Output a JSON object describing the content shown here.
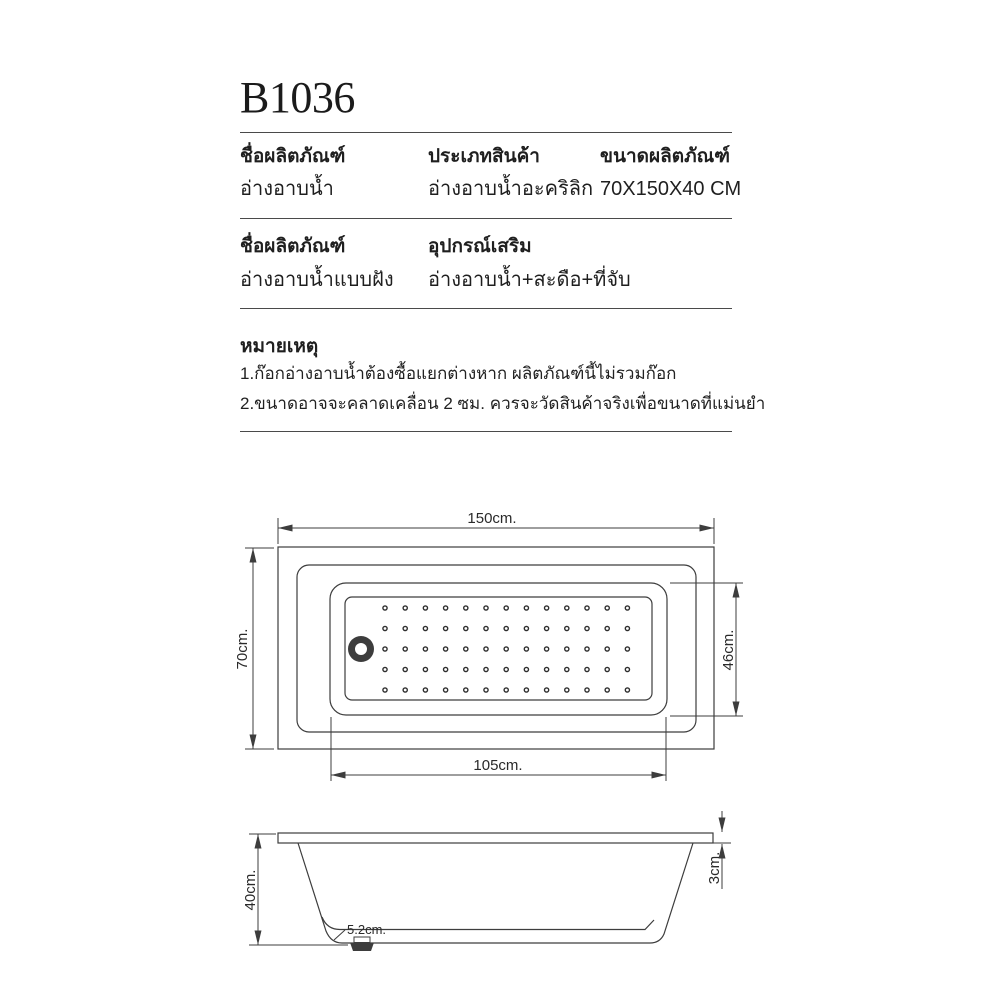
{
  "product": {
    "code": "B1036"
  },
  "spec_table_1": {
    "columns": [
      {
        "header": "ชื่อผลิตภัณฑ์",
        "value": "อ่างอาบน้ำ"
      },
      {
        "header": "ประเภทสินค้า",
        "value": "อ่างอาบน้ำอะคริลิก"
      },
      {
        "header": "ขนาดผลิตภัณฑ์",
        "value": "70X150X40 CM"
      }
    ]
  },
  "spec_table_2": {
    "columns": [
      {
        "header": "ชื่อผลิตภัณฑ์",
        "value": "อ่างอาบน้ำแบบฝัง"
      },
      {
        "header": "อุปกรณ์เสริม",
        "value": "อ่างอาบน้ำ+สะดือ+ที่จับ"
      }
    ]
  },
  "notes": {
    "heading": "หมายเหตุ",
    "items": [
      "1.ก๊อกอ่างอาบน้ำต้องซื้อแยกต่างหาก ผลิตภัณฑ์นี้ไม่รวมก๊อก",
      "2.ขนาดอาจจะคลาดเคลื่อน 2 ซม. ควรจะวัดสินค้าจริงเพื่อขนาดที่แม่นยำ"
    ]
  },
  "diagram": {
    "top_view": {
      "overall_width": "150cm.",
      "overall_depth": "70cm.",
      "basin_width": "105cm.",
      "basin_depth": "46cm.",
      "dot_grid": {
        "cols": 13,
        "rows": 5,
        "x0": 385,
        "y0": 608,
        "dx": 20.2,
        "dy": 20.5,
        "r": 2.1
      }
    },
    "side_view": {
      "overall_height": "40cm.",
      "rim_thickness": "3cm.",
      "drain_size": "5.2cm."
    }
  },
  "colors": {
    "line": "#3d3d3d",
    "text": "#1f1f1f",
    "background": "#ffffff"
  }
}
